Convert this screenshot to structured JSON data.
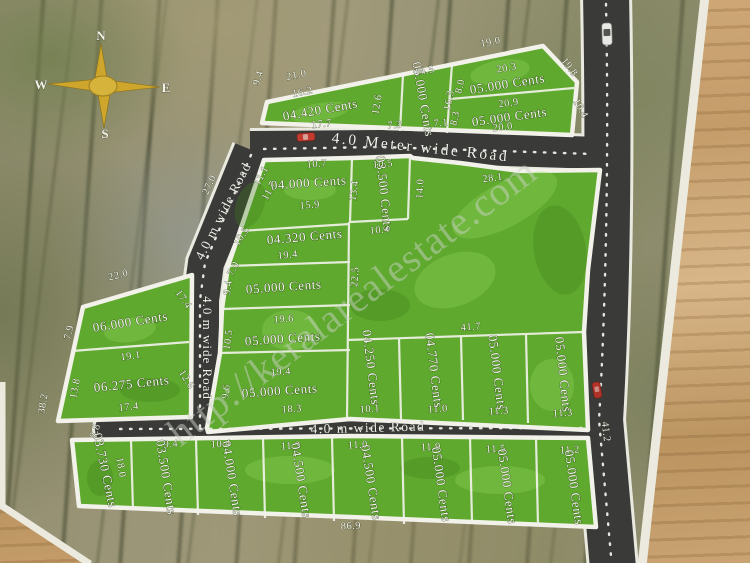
{
  "compass": {
    "north": "N",
    "east": "E",
    "south": "S",
    "west": "W"
  },
  "watermark_text": "http://keralarealestate.com",
  "roads": {
    "top": "4.0 Meter wide Road",
    "diagonal": "4.0 m wide Road",
    "vertical": "4.0 m wide Road",
    "bottom": "4.0 m wide Road",
    "right_length_mark": "41.2"
  },
  "colors": {
    "plot_green": "#5fa92e",
    "road_dark": "#3a3a38",
    "boundary_white": "#f2f2ea",
    "compass_gold": "#d2ab2e",
    "table_wood": "#c89f6e"
  },
  "plot_labels": [
    {
      "t": "04.420 Cents",
      "x": 321,
      "y": 114,
      "r": -10,
      "s": 13
    },
    {
      "t": "05.000 Cents",
      "x": 419,
      "y": 100,
      "r": 80,
      "s": 11.5
    },
    {
      "t": "05.000 Cents",
      "x": 508,
      "y": 88,
      "r": -9,
      "s": 12.5
    },
    {
      "t": "05.000 Cents",
      "x": 510,
      "y": 121,
      "r": -8,
      "s": 12.5
    },
    {
      "t": "04.000 Cents",
      "x": 309,
      "y": 187,
      "r": -4,
      "s": 13
    },
    {
      "t": "03.500 Cents",
      "x": 380,
      "y": 194,
      "r": 84,
      "s": 11
    },
    {
      "t": "04.320 Cents",
      "x": 305,
      "y": 241,
      "r": -5,
      "s": 13
    },
    {
      "t": "05.000 Cents",
      "x": 284,
      "y": 291,
      "r": -4,
      "s": 13
    },
    {
      "t": "05.000 Cents",
      "x": 283,
      "y": 343,
      "r": -4,
      "s": 13
    },
    {
      "t": "05.000 Cents",
      "x": 280,
      "y": 395,
      "r": -4,
      "s": 13
    },
    {
      "t": "06.000 Cents",
      "x": 131,
      "y": 326,
      "r": -9,
      "s": 13.5
    },
    {
      "t": "06.275 Cents",
      "x": 132,
      "y": 388,
      "r": -6,
      "s": 13.5
    },
    {
      "t": "04.250 Cents",
      "x": 367,
      "y": 368,
      "r": 83,
      "s": 11.5
    },
    {
      "t": "04.770 Cents",
      "x": 430,
      "y": 371,
      "r": 83,
      "s": 11.5
    },
    {
      "t": "05.000 Cents",
      "x": 493,
      "y": 373,
      "r": 83,
      "s": 11.5
    },
    {
      "t": "05.000 Cents",
      "x": 559,
      "y": 375,
      "r": 84,
      "s": 11.5
    },
    {
      "t": "03.730 Cents",
      "x": 101,
      "y": 471,
      "r": 78,
      "s": 11.5
    },
    {
      "t": "03.500 Cents",
      "x": 162,
      "y": 478,
      "r": 81,
      "s": 11.5
    },
    {
      "t": "04.000 Cents",
      "x": 228,
      "y": 479,
      "r": 81,
      "s": 11.5
    },
    {
      "t": "04.500 Cents",
      "x": 297,
      "y": 481,
      "r": 81,
      "s": 11.5
    },
    {
      "t": "04.500 Cents",
      "x": 367,
      "y": 483,
      "r": 81,
      "s": 11.5
    },
    {
      "t": "05.000 Cents",
      "x": 437,
      "y": 485,
      "r": 82,
      "s": 11.5
    },
    {
      "t": "05.000 Cents",
      "x": 503,
      "y": 487,
      "r": 82,
      "s": 11.5
    },
    {
      "t": "05.000 Cents",
      "x": 570,
      "y": 488,
      "r": 82,
      "s": 11.5
    }
  ],
  "dimension_labels": [
    {
      "t": "21.0",
      "x": 297,
      "y": 78,
      "r": -12
    },
    {
      "t": "16.2",
      "x": 303,
      "y": 95,
      "r": -11
    },
    {
      "t": "9.4",
      "x": 261,
      "y": 79,
      "r": -72
    },
    {
      "t": "17.7",
      "x": 322,
      "y": 127,
      "r": -6
    },
    {
      "t": "14.5",
      "x": 425,
      "y": 74,
      "r": -11
    },
    {
      "t": "12.6",
      "x": 380,
      "y": 105,
      "r": -80
    },
    {
      "t": "16.3",
      "x": 452,
      "y": 101,
      "r": -78
    },
    {
      "t": "7.3",
      "x": 395,
      "y": 128,
      "r": -5
    },
    {
      "t": "7.1",
      "x": 441,
      "y": 126,
      "r": -5
    },
    {
      "t": "19.0",
      "x": 491,
      "y": 45,
      "r": -10
    },
    {
      "t": "20.3",
      "x": 507,
      "y": 71,
      "r": -9
    },
    {
      "t": "8.0",
      "x": 463,
      "y": 87,
      "r": -76
    },
    {
      "t": "19.8",
      "x": 567,
      "y": 69,
      "r": 52
    },
    {
      "t": "20.9",
      "x": 509,
      "y": 106,
      "r": -8
    },
    {
      "t": "8.3",
      "x": 458,
      "y": 119,
      "r": -76
    },
    {
      "t": "20.0",
      "x": 503,
      "y": 130,
      "r": -6
    },
    {
      "t": "10.4",
      "x": 578,
      "y": 110,
      "r": 60
    },
    {
      "t": "27.0",
      "x": 212,
      "y": 186,
      "r": -65
    },
    {
      "t": "10.7",
      "x": 317,
      "y": 167,
      "r": -5
    },
    {
      "t": "11.1",
      "x": 264,
      "y": 177,
      "r": -62
    },
    {
      "t": "11.7",
      "x": 272,
      "y": 192,
      "r": -62
    },
    {
      "t": "15.9",
      "x": 310,
      "y": 208,
      "r": -5
    },
    {
      "t": "13.4",
      "x": 357,
      "y": 191,
      "r": -82
    },
    {
      "t": "10.5",
      "x": 383,
      "y": 167,
      "r": -5
    },
    {
      "t": "14.0",
      "x": 423,
      "y": 189,
      "r": -86
    },
    {
      "t": "28.1",
      "x": 493,
      "y": 181,
      "r": -8
    },
    {
      "t": "10.5",
      "x": 244,
      "y": 238,
      "r": -55
    },
    {
      "t": "19.4",
      "x": 288,
      "y": 258,
      "r": -5
    },
    {
      "t": "10.4",
      "x": 380,
      "y": 233,
      "r": -5
    },
    {
      "t": "22.5",
      "x": 358,
      "y": 277,
      "r": -86
    },
    {
      "t": "41.7",
      "x": 471,
      "y": 330,
      "r": -4
    },
    {
      "t": "7.0",
      "x": 236,
      "y": 270,
      "r": -62
    },
    {
      "t": "9.4",
      "x": 231,
      "y": 288,
      "r": -82
    },
    {
      "t": "19.6",
      "x": 284,
      "y": 322,
      "r": -4
    },
    {
      "t": "10.5",
      "x": 231,
      "y": 340,
      "r": -83
    },
    {
      "t": "19.4",
      "x": 281,
      "y": 375,
      "r": -4
    },
    {
      "t": "9.6",
      "x": 229,
      "y": 392,
      "r": -83
    },
    {
      "t": "18.3",
      "x": 292,
      "y": 412,
      "r": -4
    },
    {
      "t": "22.0",
      "x": 119,
      "y": 278,
      "r": -14
    },
    {
      "t": "7.9",
      "x": 72,
      "y": 333,
      "r": -76
    },
    {
      "t": "17.4",
      "x": 181,
      "y": 301,
      "r": 55
    },
    {
      "t": "19.1",
      "x": 131,
      "y": 359,
      "r": -8
    },
    {
      "t": "13.8",
      "x": 78,
      "y": 389,
      "r": -79
    },
    {
      "t": "12.6",
      "x": 184,
      "y": 381,
      "r": 58
    },
    {
      "t": "17.4",
      "x": 129,
      "y": 410,
      "r": -6
    },
    {
      "t": "38.2",
      "x": 46,
      "y": 404,
      "r": -81
    },
    {
      "t": "8.8",
      "x": 98,
      "y": 432,
      "r": -70
    },
    {
      "t": "10.1",
      "x": 370,
      "y": 412,
      "r": -4
    },
    {
      "t": "11.0",
      "x": 438,
      "y": 412,
      "r": -4
    },
    {
      "t": "11.3",
      "x": 499,
      "y": 414,
      "r": -4
    },
    {
      "t": "11.3",
      "x": 563,
      "y": 416,
      "r": -4
    },
    {
      "t": "9.4",
      "x": 171,
      "y": 447,
      "r": -3
    },
    {
      "t": "10.4",
      "x": 221,
      "y": 447,
      "r": -3
    },
    {
      "t": "11.3",
      "x": 291,
      "y": 449,
      "r": -3
    },
    {
      "t": "11.0",
      "x": 358,
      "y": 448,
      "r": -3
    },
    {
      "t": "11.9",
      "x": 431,
      "y": 450,
      "r": -3
    },
    {
      "t": "11.5",
      "x": 496,
      "y": 452,
      "r": -3
    },
    {
      "t": "11.2",
      "x": 570,
      "y": 453,
      "r": -3
    },
    {
      "t": "18.0",
      "x": 118,
      "y": 468,
      "r": 80
    },
    {
      "t": "86.9",
      "x": 351,
      "y": 529,
      "r": -3
    },
    {
      "t": "41.2",
      "x": 603,
      "y": 432,
      "r": 84
    }
  ]
}
